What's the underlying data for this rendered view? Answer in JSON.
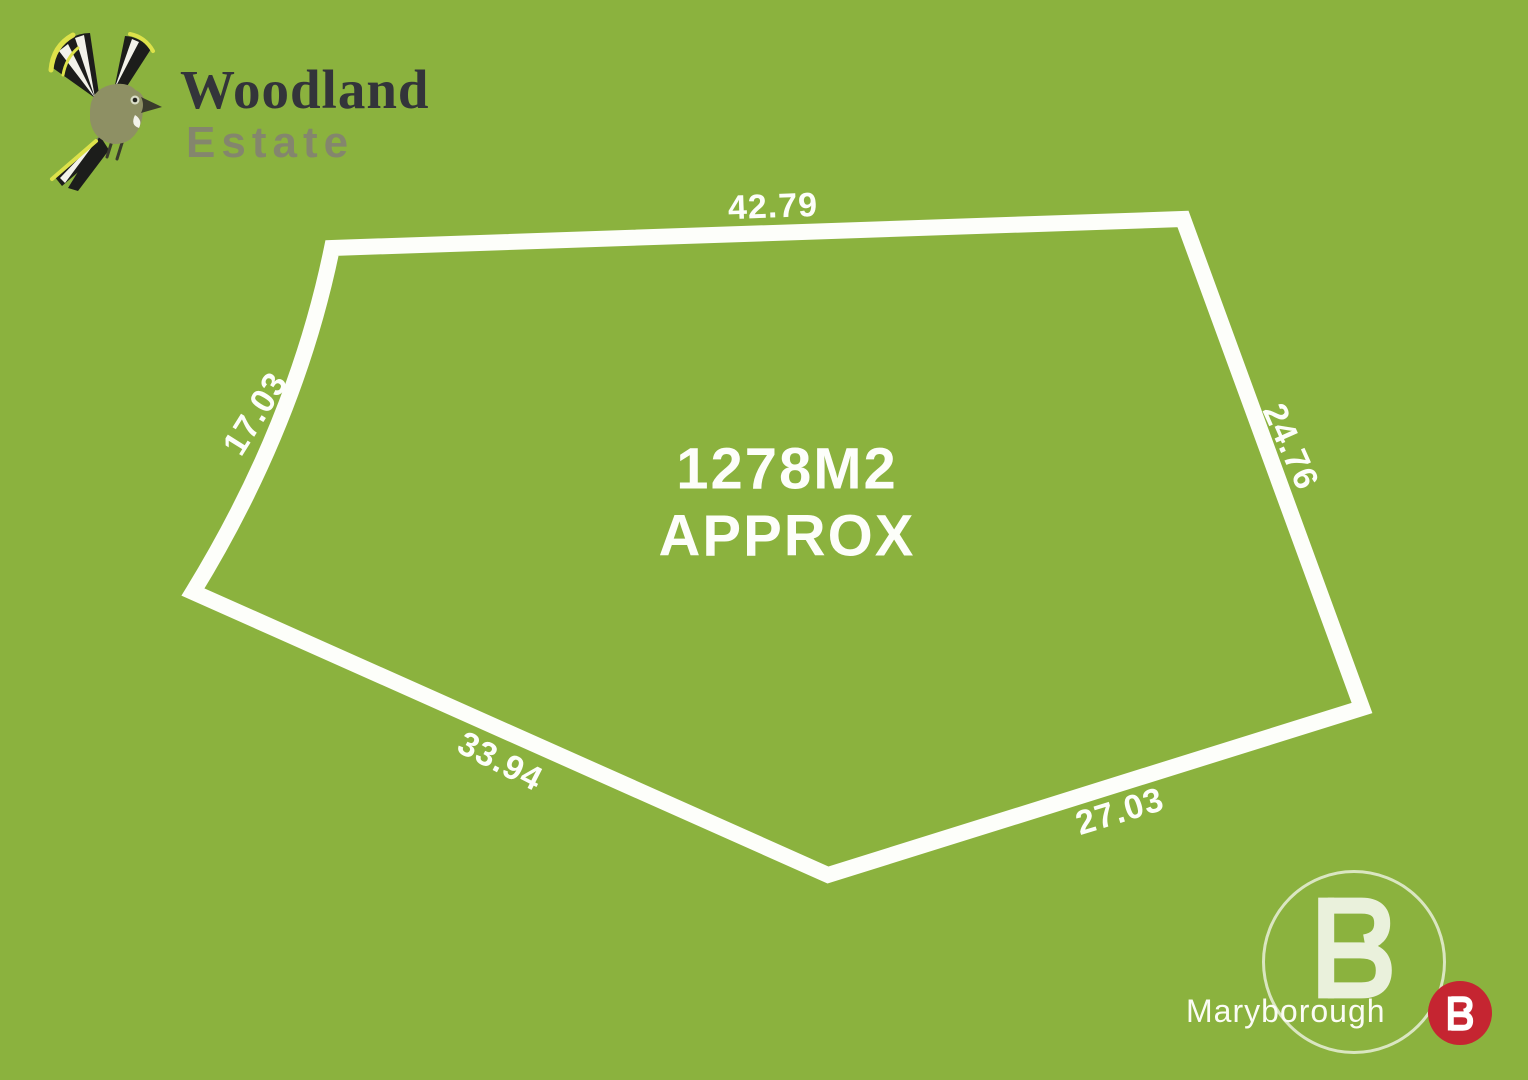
{
  "brand": {
    "line1": "Woodland",
    "line2": "Estate",
    "logo": "bird-icon"
  },
  "lot": {
    "area_line1": "1278M2",
    "area_line2": "APPROX",
    "dimensions": {
      "top": "42.79",
      "right": "24.76",
      "bottom_right": "27.03",
      "bottom_left": "33.94",
      "left": "17.03"
    }
  },
  "footer": {
    "office": "Maryborough",
    "monogram_letter": "B"
  },
  "colors": {
    "background": "#8bb23e",
    "boundary_line": "#ffffff",
    "badge_red": "#c52531",
    "brand_dark": "#33343a",
    "brand_olive": "#84866d"
  }
}
